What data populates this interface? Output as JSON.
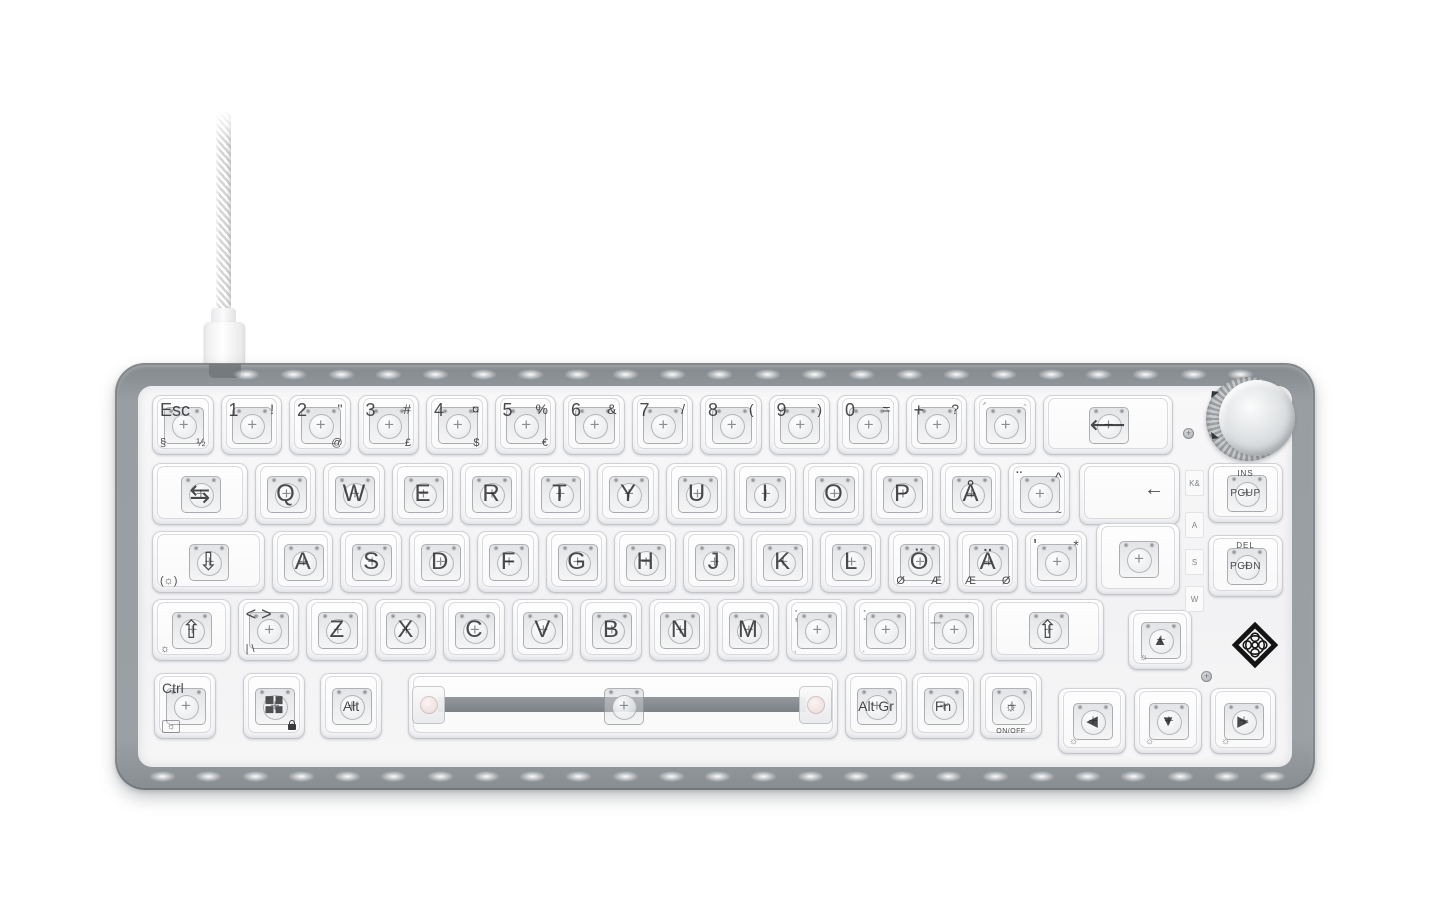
{
  "product": {
    "description": "Transparent white mechanical gaming keyboard, Nordic ISO 65% layout with volume knob, white braided USB cable, white LED frame lighting"
  },
  "colors": {
    "frame_gray": "#9aa0a3",
    "panel_white": "#f4f4f6",
    "legend": "#202024",
    "led": "#ffffff",
    "knob_silver": "#dcdfe1",
    "stabilizer_gray": "#85898d",
    "logo_black": "#141414"
  },
  "keyboard": {
    "unit": 68.5,
    "origin_x": 152,
    "rows": [
      {
        "y": 395,
        "h": 60,
        "keys": [
          {
            "id": "esc",
            "tl": "Esc",
            "bl": "§",
            "br": "½"
          },
          {
            "id": "1",
            "tl": "1",
            "tr": "!"
          },
          {
            "id": "2",
            "tl": "2",
            "tr": "\"",
            "br": "@"
          },
          {
            "id": "3",
            "tl": "3",
            "tr": "#",
            "br": "£"
          },
          {
            "id": "4",
            "tl": "4",
            "tr": "¤",
            "br": "$"
          },
          {
            "id": "5",
            "tl": "5",
            "tr": "%",
            "br": "€"
          },
          {
            "id": "6",
            "tl": "6",
            "tr": "&"
          },
          {
            "id": "7",
            "tl": "7",
            "tr": "/"
          },
          {
            "id": "8",
            "tl": "8",
            "tr": "("
          },
          {
            "id": "9",
            "tl": "9",
            "tr": ")"
          },
          {
            "id": "0",
            "tl": "0",
            "tr": "="
          },
          {
            "id": "plus",
            "tl": "+",
            "tr": "?"
          },
          {
            "id": "acute",
            "tl": "´",
            "tr": "`",
            "faint": true
          },
          {
            "id": "backspace",
            "c": "⟵",
            "w": 2,
            "big": true
          }
        ]
      },
      {
        "y": 463,
        "h": 62,
        "keys": [
          {
            "id": "tab",
            "c": "⇆",
            "w": 1.5,
            "big": true
          },
          {
            "id": "q",
            "c": "Q"
          },
          {
            "id": "w",
            "c": "W"
          },
          {
            "id": "e",
            "c": "E"
          },
          {
            "id": "r",
            "c": "R"
          },
          {
            "id": "t",
            "c": "T"
          },
          {
            "id": "y",
            "c": "Y"
          },
          {
            "id": "u",
            "c": "U"
          },
          {
            "id": "i",
            "c": "I"
          },
          {
            "id": "o",
            "c": "O"
          },
          {
            "id": "p",
            "c": "P"
          },
          {
            "id": "aring",
            "c": "Å"
          },
          {
            "id": "diaeresis",
            "tl": "¨",
            "tr": "^",
            "br": "~"
          }
        ]
      },
      {
        "y": 531,
        "h": 62,
        "keys": [
          {
            "id": "caps",
            "c": "⇩",
            "bl": "(☼)",
            "w": 1.75,
            "big": true
          },
          {
            "id": "a",
            "c": "A"
          },
          {
            "id": "s",
            "c": "S"
          },
          {
            "id": "d",
            "c": "D"
          },
          {
            "id": "f",
            "c": "F"
          },
          {
            "id": "g",
            "c": "G"
          },
          {
            "id": "h",
            "c": "H"
          },
          {
            "id": "j",
            "c": "J"
          },
          {
            "id": "k",
            "c": "K"
          },
          {
            "id": "l",
            "c": "L"
          },
          {
            "id": "odiaeresis",
            "c": "Ö",
            "bl": "Ø",
            "br": "Æ"
          },
          {
            "id": "adiaeresis",
            "c": "Ä",
            "bl": "Æ",
            "br": "Ø"
          },
          {
            "id": "apostrophe",
            "tl": "'",
            "tr": "*"
          }
        ]
      },
      {
        "y": 599,
        "h": 62,
        "keys": [
          {
            "id": "lshift",
            "c": "⇧",
            "bl": "☼",
            "w": 1.25,
            "big": true
          },
          {
            "id": "less-greater",
            "tl": "< >",
            "bl": "| \\"
          },
          {
            "id": "z",
            "c": "Z"
          },
          {
            "id": "x",
            "c": "X"
          },
          {
            "id": "c",
            "c": "C"
          },
          {
            "id": "v",
            "c": "V"
          },
          {
            "id": "b",
            "c": "B"
          },
          {
            "id": "n",
            "c": "N"
          },
          {
            "id": "m",
            "c": "M"
          },
          {
            "id": "comma",
            "tl": ";",
            "bl": ",",
            "faint": true
          },
          {
            "id": "period",
            "tl": ":",
            "bl": ".",
            "faint": true
          },
          {
            "id": "dash",
            "tl": "_",
            "bl": "-",
            "faint": true
          },
          {
            "id": "rshift",
            "c": "⇧",
            "w": 1.75,
            "big": true
          }
        ]
      },
      {
        "y": 673,
        "h": 66,
        "keys": [
          {
            "id": "ctrl",
            "x": 154,
            "w": 62,
            "tl": "Ctrl",
            "bl": "☼",
            "boxed": true,
            "small": true
          },
          {
            "id": "win",
            "x": 243,
            "w": 62,
            "icon": "windows-logo",
            "lock": true
          },
          {
            "id": "alt",
            "x": 320,
            "w": 62,
            "c": "Alt",
            "small": true
          },
          {
            "id": "space",
            "x": 408,
            "w": 430,
            "type": "space"
          },
          {
            "id": "altgr",
            "x": 845,
            "w": 62,
            "c": "Alt Gr",
            "small": true
          },
          {
            "id": "fn",
            "x": 912,
            "w": 62,
            "c": "Fn",
            "small": true
          },
          {
            "id": "light",
            "x": 980,
            "w": 62,
            "c": "☼",
            "sub": "ON/OFF",
            "small": true
          }
        ]
      }
    ],
    "enter": {
      "legend": "←",
      "upper": {
        "x": 1079,
        "y": 463,
        "w": 101,
        "h": 62
      },
      "lower": {
        "x": 1096,
        "y": 523,
        "w": 84,
        "h": 72
      }
    },
    "nav_keys": [
      {
        "id": "ins-pgup",
        "t": "INS",
        "b": "PGUP",
        "x": 1208,
        "y": 463,
        "w": 75,
        "h": 60
      },
      {
        "id": "del-pgdn",
        "t": "DEL",
        "b": "PGDN",
        "x": 1208,
        "y": 535,
        "w": 75,
        "h": 62
      }
    ],
    "arrow_keys": [
      {
        "id": "arrow-up",
        "c": "▲",
        "bl": "☼",
        "x": 1128,
        "y": 610,
        "w": 64,
        "h": 60
      },
      {
        "id": "arrow-left",
        "c": "◀",
        "bl": "☼",
        "x": 1058,
        "y": 688,
        "w": 68,
        "h": 66
      },
      {
        "id": "arrow-down",
        "c": "▼",
        "bl": "☼",
        "x": 1134,
        "y": 688,
        "w": 68,
        "h": 66
      },
      {
        "id": "arrow-right",
        "c": "▶",
        "bl": "☼",
        "x": 1210,
        "y": 688,
        "w": 66,
        "h": 66
      }
    ],
    "side_labels": {
      "items": [
        {
          "t": "K&",
          "y": 470
        },
        {
          "t": "A",
          "y": 512
        },
        {
          "t": "S",
          "y": 549
        },
        {
          "t": "W",
          "y": 586
        }
      ]
    },
    "screws": [
      {
        "x": 1183,
        "y": 428
      },
      {
        "x": 652,
        "y": 699
      },
      {
        "x": 1201,
        "y": 671
      }
    ],
    "leds": {
      "top": {
        "y": 369,
        "x0": 246,
        "x1": 1240,
        "n": 22
      },
      "bottom": {
        "y": 771,
        "x0": 162,
        "x1": 1272,
        "n": 25
      }
    }
  }
}
